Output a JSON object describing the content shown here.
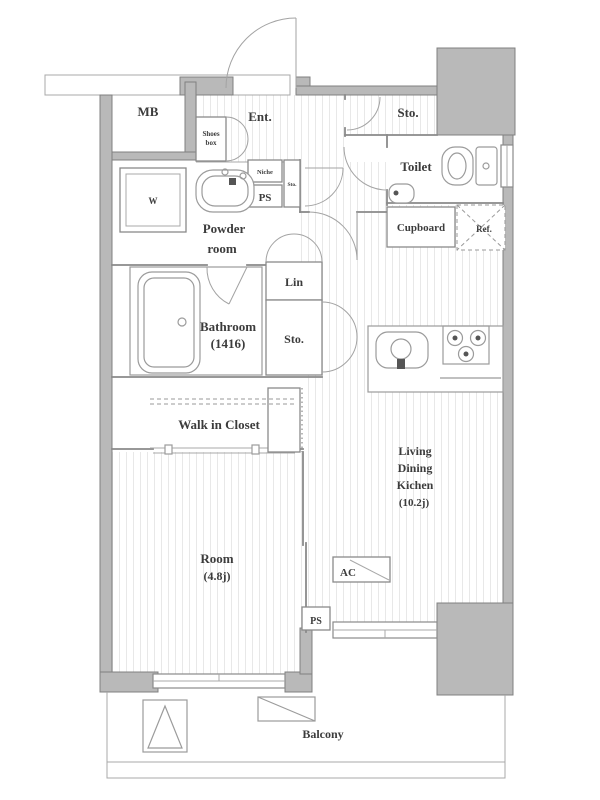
{
  "title": "apartment-floorplan",
  "colors": {
    "wall_fill": "#b9b9b9",
    "wall_stroke": "#808080",
    "interior_line": "#8a8a8a",
    "floor_stripe": "#e8e8e8",
    "label_text": "#3c3c3c"
  },
  "rooms": {
    "mb": "MB",
    "entrance": "Ent.",
    "shoes_box_line1": "Shoes",
    "shoes_box_line2": "box",
    "niche": "Niche",
    "pipe_space_upper": "PS",
    "storage_small": "Sto.",
    "powder_line1": "Powder",
    "powder_line2": "room",
    "washer": "W",
    "storage_top": "Sto.",
    "toilet": "Toilet",
    "cupboard": "Cupboard",
    "refrigerator": "Ref.",
    "linen": "Lin",
    "bathroom_line1": "Bathroom",
    "bathroom_line2": "(1416)",
    "storage_mid": "Sto.",
    "walk_in_closet": "Walk in Closet",
    "room_line1": "Room",
    "room_line2": "(4.8j)",
    "ldk_line1": "Living",
    "ldk_line2": "Dining",
    "ldk_line3": "Kichen",
    "ldk_line4": "(10.2j)",
    "ac_unit": "AC",
    "pipe_space_lower": "PS",
    "balcony": "Balcony"
  }
}
